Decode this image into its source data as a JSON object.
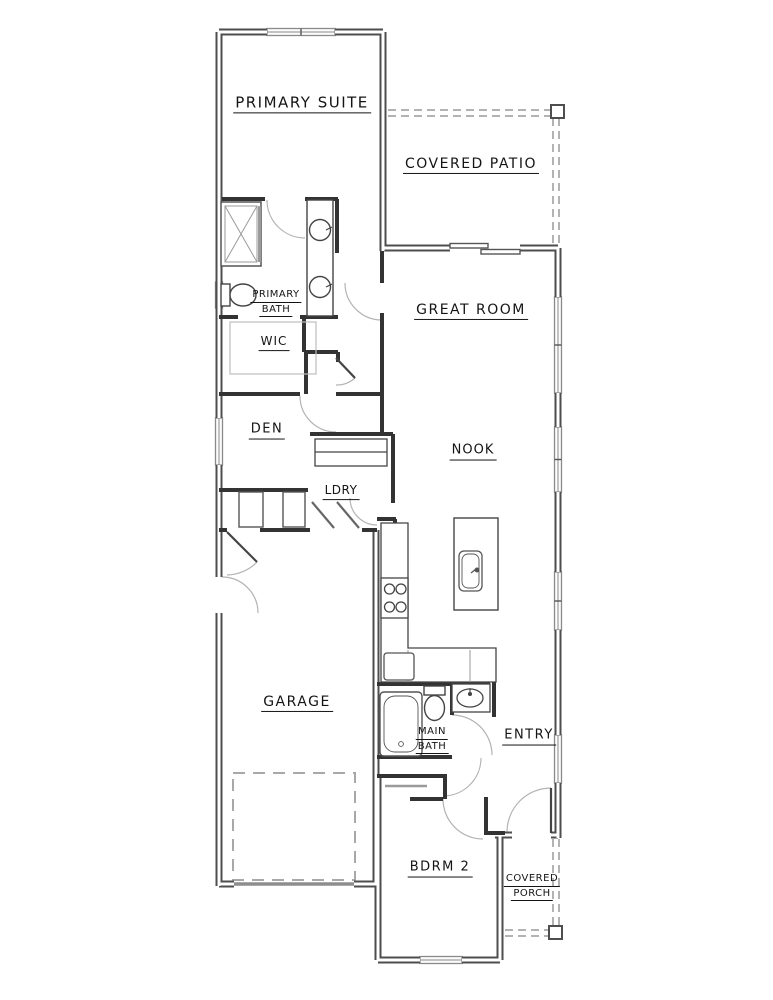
{
  "plan_title": "Single-story floor plan",
  "colors": {
    "background": "#ffffff",
    "exterior_wall": "#4e4e4e",
    "wall_core": "#ffffff",
    "interior_wall": "#333333",
    "window": "#8a8a8a",
    "door_arc": "#b3b3b3",
    "dashed_outline": "#9a9a9a",
    "text": "#141414"
  },
  "rooms": [
    {
      "id": "primary-suite",
      "label": "PRIMARY SUITE",
      "lines": [
        "PRIMARY SUITE"
      ],
      "x": 302,
      "y": 104,
      "size": 15,
      "ls": 1.5
    },
    {
      "id": "covered-patio",
      "label": "COVERED PATIO",
      "lines": [
        "COVERED PATIO"
      ],
      "x": 471,
      "y": 165,
      "size": 14,
      "ls": 1.5
    },
    {
      "id": "primary-bath",
      "label": "PRIMARY BATH",
      "lines": [
        "PRIMARY",
        "BATH"
      ],
      "x": 276,
      "y": 303,
      "size": 10,
      "ls": 0.5
    },
    {
      "id": "wic",
      "label": "WIC",
      "lines": [
        "WIC"
      ],
      "x": 274,
      "y": 343,
      "size": 12,
      "ls": 1
    },
    {
      "id": "great-room",
      "label": "GREAT ROOM",
      "lines": [
        "GREAT ROOM"
      ],
      "x": 471,
      "y": 311,
      "size": 14,
      "ls": 1.5
    },
    {
      "id": "den",
      "label": "DEN",
      "lines": [
        "DEN"
      ],
      "x": 267,
      "y": 431,
      "size": 13,
      "ls": 1.5
    },
    {
      "id": "nook",
      "label": "NOOK",
      "lines": [
        "NOOK"
      ],
      "x": 473,
      "y": 452,
      "size": 13,
      "ls": 1
    },
    {
      "id": "ldry",
      "label": "LDRY",
      "lines": [
        "LDRY"
      ],
      "x": 341,
      "y": 492,
      "size": 12,
      "ls": 0.5
    },
    {
      "id": "garage",
      "label": "GARAGE",
      "lines": [
        "GARAGE"
      ],
      "x": 297,
      "y": 703,
      "size": 14,
      "ls": 1.5
    },
    {
      "id": "main-bath",
      "label": "MAIN BATH",
      "lines": [
        "MAIN",
        "BATH"
      ],
      "x": 432,
      "y": 740,
      "size": 10,
      "ls": 0.5
    },
    {
      "id": "entry",
      "label": "ENTRY",
      "lines": [
        "ENTRY"
      ],
      "x": 529,
      "y": 737,
      "size": 13,
      "ls": 1.5
    },
    {
      "id": "bdrm-2",
      "label": "BDRM 2",
      "lines": [
        "BDRM 2"
      ],
      "x": 440,
      "y": 869,
      "size": 13,
      "ls": 1.5
    },
    {
      "id": "covered-porch",
      "label": "COVERED PORCH",
      "lines": [
        "COVERED",
        "PORCH"
      ],
      "x": 532,
      "y": 887,
      "size": 10,
      "ls": 0.5
    }
  ],
  "fixtures": [
    "shower-icon",
    "toilet-icon",
    "double-vanity-sink-icon",
    "walk-in-closet-shelving-icon",
    "washer-icon",
    "dryer-icon",
    "laundry-cabinet-icon",
    "kitchen-counter-icon",
    "range-stove-icon",
    "refrigerator-icon",
    "kitchen-island-icon",
    "island-sink-icon",
    "bathtub-icon",
    "bath-sink-icon",
    "sliding-glass-door-icon",
    "garage-door-icon",
    "front-door-icon",
    "patio-post-icon",
    "porch-post-icon"
  ]
}
